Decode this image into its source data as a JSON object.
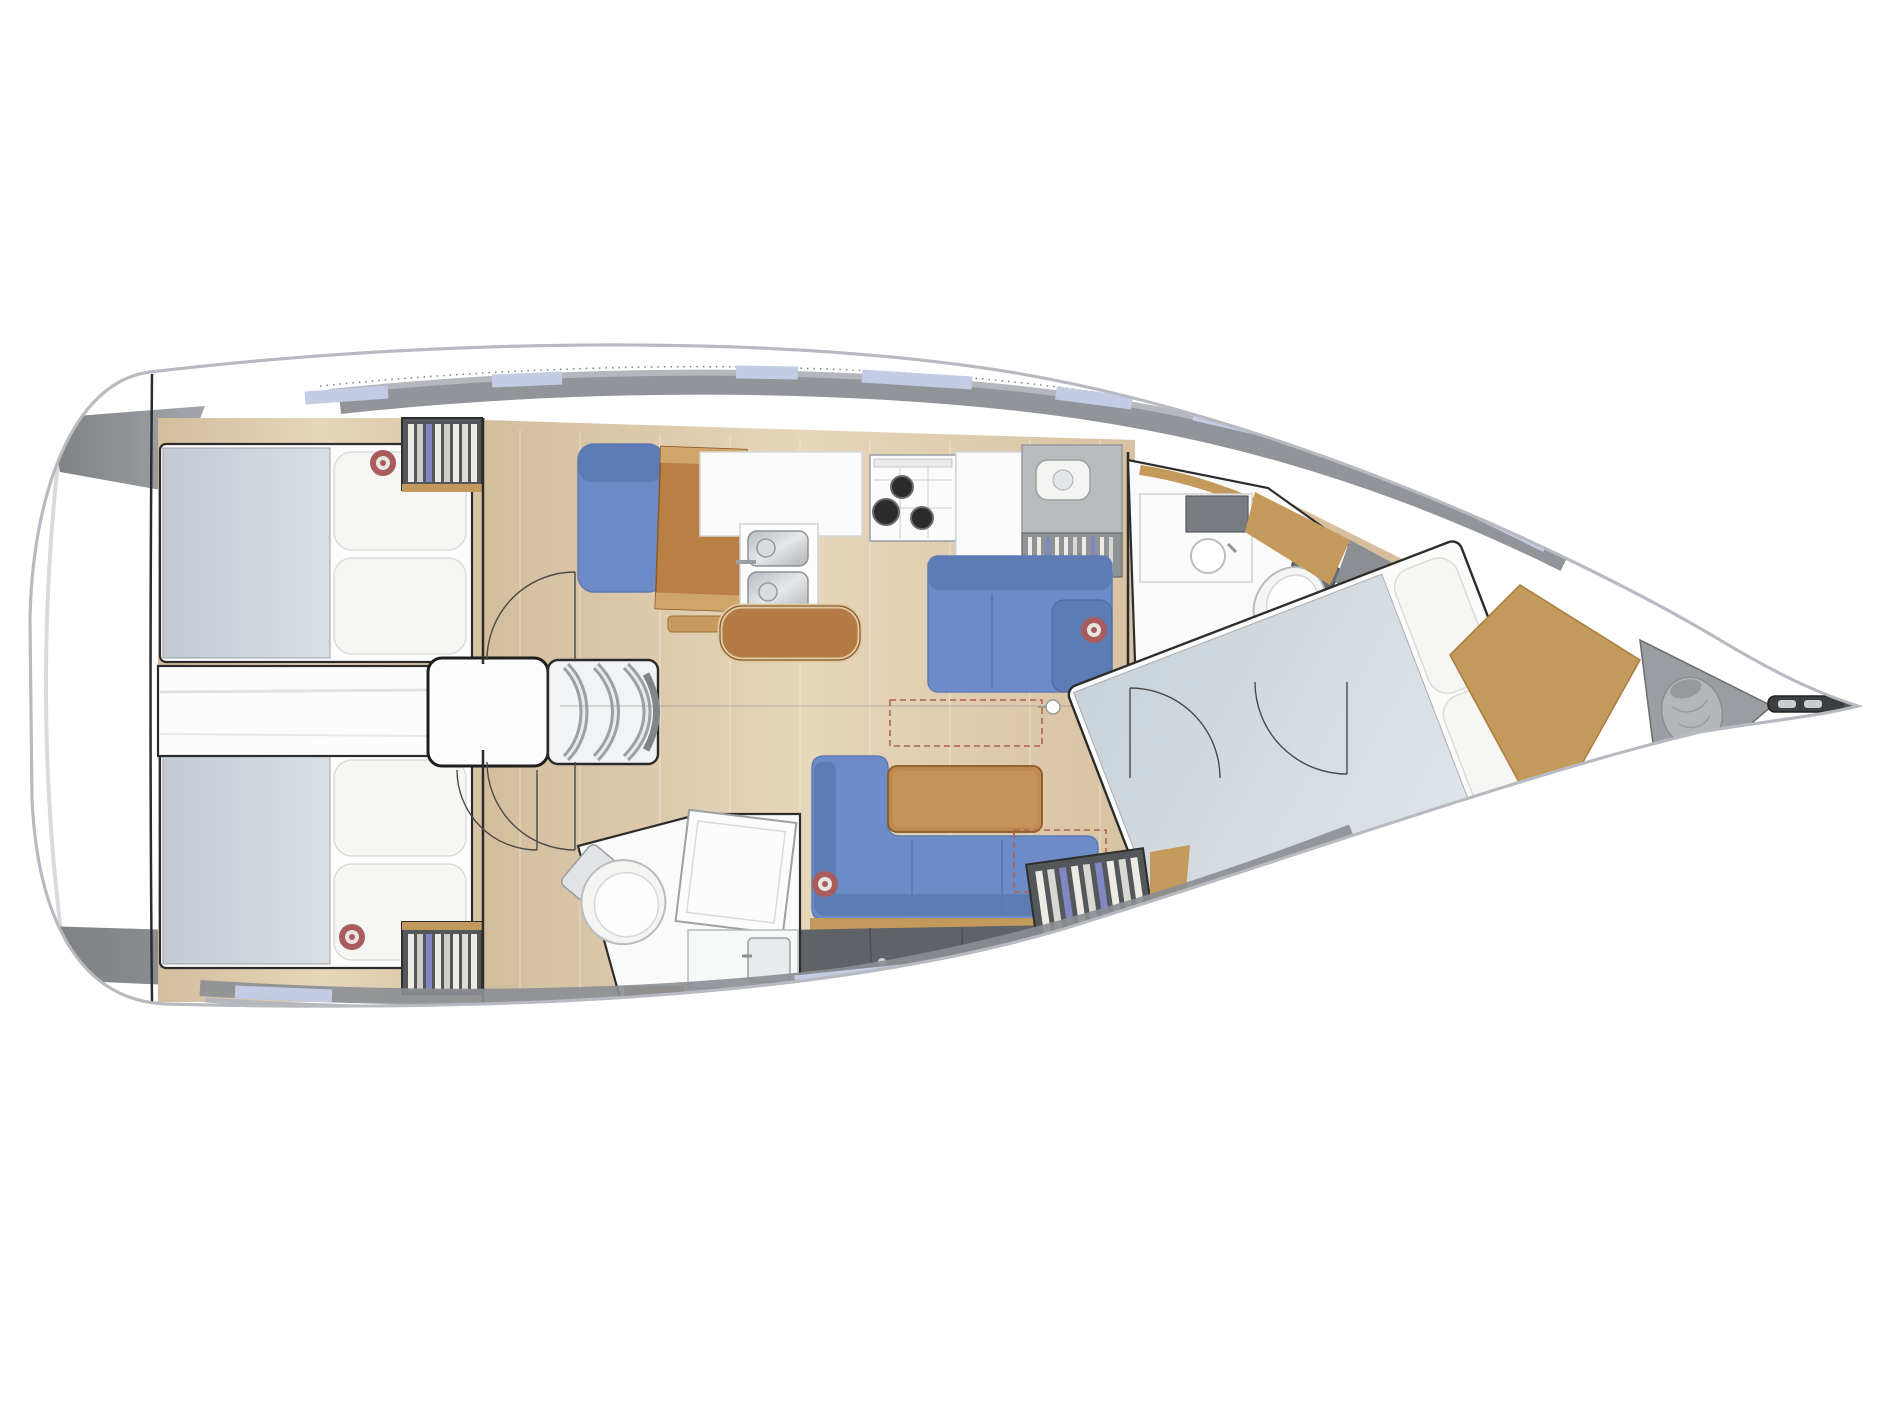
{
  "diagram": {
    "kind": "sailboat-interior-floorplan-top-view",
    "orientation": {
      "bow": "right",
      "stern": "left"
    },
    "colors": {
      "hull_outline": "#b7bac0",
      "rim_light": "#e3e5e8",
      "deck_gray": "#8b8e92",
      "deck_gray_light": "#b4b7bc",
      "window_blue": "#c3cce4",
      "floor_wood_a": "#d3bd9d",
      "floor_wood_b": "#e6d6ba",
      "floor_wood_c": "#cdb391",
      "upholstery_blue": "#6d8cc7",
      "upholstery_blue_dark": "#5e7cb4",
      "table_wood": "#c08a50",
      "wood_trim": "#c49a5c",
      "leather_brown": "#b57b45",
      "chart_wood": "#b97f44",
      "bed_gray_a": "#c3cad2",
      "bed_gray_b": "#dadfe4",
      "pillow_white": "#f6f6f4",
      "room_white": "#fafafa",
      "cabinet_dark": "#5f6266",
      "wardrobe_dark": "#54575a",
      "clothes_cream": "#ecebe4",
      "clothes_blue": "#8087c2",
      "steel_a": "#b8bcc0",
      "steel_b": "#e5e7e9",
      "burner_black": "#2b2b2b",
      "speaker_red": "#a85c5c",
      "dash_red": "#b0634f",
      "line_dark": "#2c2c2c",
      "locker_gray": "#9a9da1",
      "bag_gray": "#b4b6b9",
      "hardware_dark": "#3c3e40"
    },
    "areas": {
      "hull": {
        "label": "yacht hull, bow pointing right"
      },
      "aft_cabin_port": {
        "label": "aft cabin port with double bed, pillows, wardrobe, speaker"
      },
      "aft_cabin_starboard": {
        "label": "aft cabin starboard with double bed, pillows, wardrobe, speaker"
      },
      "companionway": {
        "label": "companionway steps and engine compartment"
      },
      "nav_station": {
        "label": "navigation station with blue seat and chart table"
      },
      "galley": {
        "label": "galley with sink, three-burner stove, fridge counter and plate rack"
      },
      "salon": {
        "label": "salon with L-shaped blue sofa, bench settee and wood table"
      },
      "aft_head": {
        "label": "aft bathroom with toilet, shower panel and vanity"
      },
      "forward_head": {
        "label": "forward bathroom with vanity sink and toilet"
      },
      "forward_cabin": {
        "label": "forward cabin with angled double bed, pillows and wardrobe"
      },
      "bow": {
        "label": "bow with anchor locker, sail bag and anchor roller"
      }
    }
  }
}
